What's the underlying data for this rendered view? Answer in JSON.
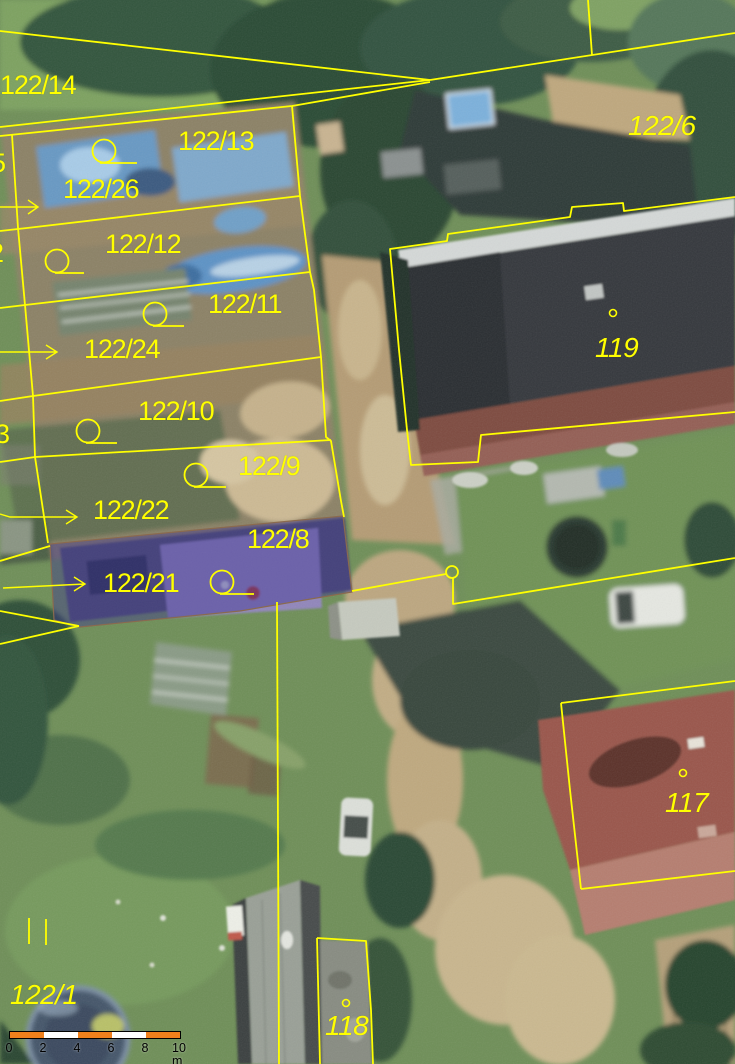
{
  "map": {
    "kind": "cadastral-parcel-map-over-aerial-imagery",
    "line_color": "#ffff00",
    "highlight": {
      "parcel": "122/8",
      "fill": "rgba(60,50,148,0.42)",
      "border": "#8a6a4f"
    },
    "labels": [
      {
        "text": "122/14",
        "x": 0,
        "y": 72,
        "style": "parcel"
      },
      {
        "text": "122/13",
        "x": 178,
        "y": 128,
        "style": "parcel"
      },
      {
        "text": "122/26",
        "x": 63,
        "y": 176,
        "style": "parcel"
      },
      {
        "text": "122/12",
        "x": 105,
        "y": 231,
        "style": "parcel"
      },
      {
        "text": "122/11",
        "x": 208,
        "y": 291,
        "style": "parcel"
      },
      {
        "text": "122/24",
        "x": 84,
        "y": 336,
        "style": "parcel"
      },
      {
        "text": "122/10",
        "x": 138,
        "y": 398,
        "style": "parcel"
      },
      {
        "text": "122/9",
        "x": 238,
        "y": 453,
        "style": "parcel"
      },
      {
        "text": "122/22",
        "x": 93,
        "y": 497,
        "style": "parcel"
      },
      {
        "text": "122/8",
        "x": 247,
        "y": 526,
        "style": "parcel"
      },
      {
        "text": "122/21",
        "x": 103,
        "y": 570,
        "style": "parcel"
      },
      {
        "text": "5",
        "x": -9,
        "y": 150,
        "style": "parcel"
      },
      {
        "text": "2",
        "x": -11,
        "y": 240,
        "style": "parcel"
      },
      {
        "text": "3",
        "x": -5,
        "y": 421,
        "style": "parcel"
      },
      {
        "text": "122/6",
        "x": 628,
        "y": 112,
        "style": "building"
      },
      {
        "text": "119",
        "x": 595,
        "y": 334,
        "style": "building"
      },
      {
        "text": "117",
        "x": 665,
        "y": 789,
        "style": "building"
      },
      {
        "text": "118",
        "x": 325,
        "y": 1012,
        "style": "building"
      },
      {
        "text": "122/1",
        "x": 10,
        "y": 981,
        "style": "building"
      }
    ],
    "scale_bar": {
      "ticks": [
        "0",
        "2",
        "4",
        "6",
        "8"
      ],
      "end_label": "10 m",
      "segment_colors": [
        "#f0801c",
        "#ffffff",
        "#f0801c",
        "#ffffff",
        "#f0801c"
      ],
      "border_color": "#000000",
      "label_color": "#000000"
    }
  }
}
